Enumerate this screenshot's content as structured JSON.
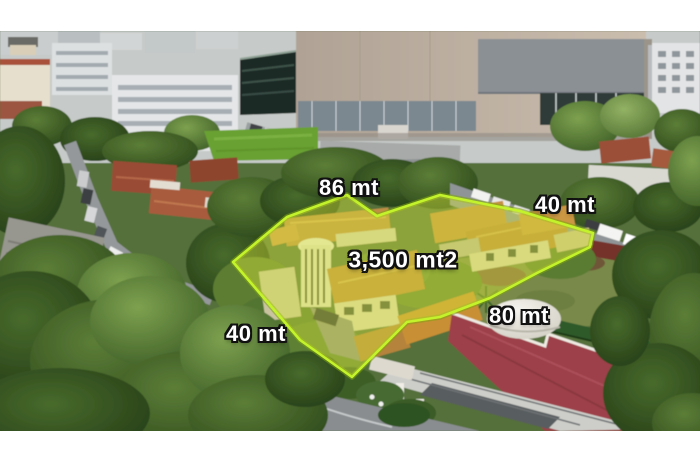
{
  "image": {
    "type": "aerial-drone-photo",
    "description": "Aerial drone photo of a corner property outlined in bright yellow-green with its lot area and side lengths annotated; surrounded by tiled-roof houses, dense trees, streets with parked cars, a large windowless commercial building at top and a red-roofed building at bottom right; white bands frame the photo top and bottom"
  },
  "lot": {
    "area_label": "3,500 mt2",
    "side_top_label": "86 mt",
    "side_right_label": "40 mt",
    "side_bottom_right_label": "80 mt",
    "side_bottom_left_label": "40 mt"
  },
  "colors": {
    "frame": "#ffffff",
    "lot_fill": "#d9e63a",
    "lot_outline": "#c3f32b",
    "lot_outline_glow": "#7fa411",
    "label_text": "#ffffff",
    "label_outline": "#111111"
  }
}
